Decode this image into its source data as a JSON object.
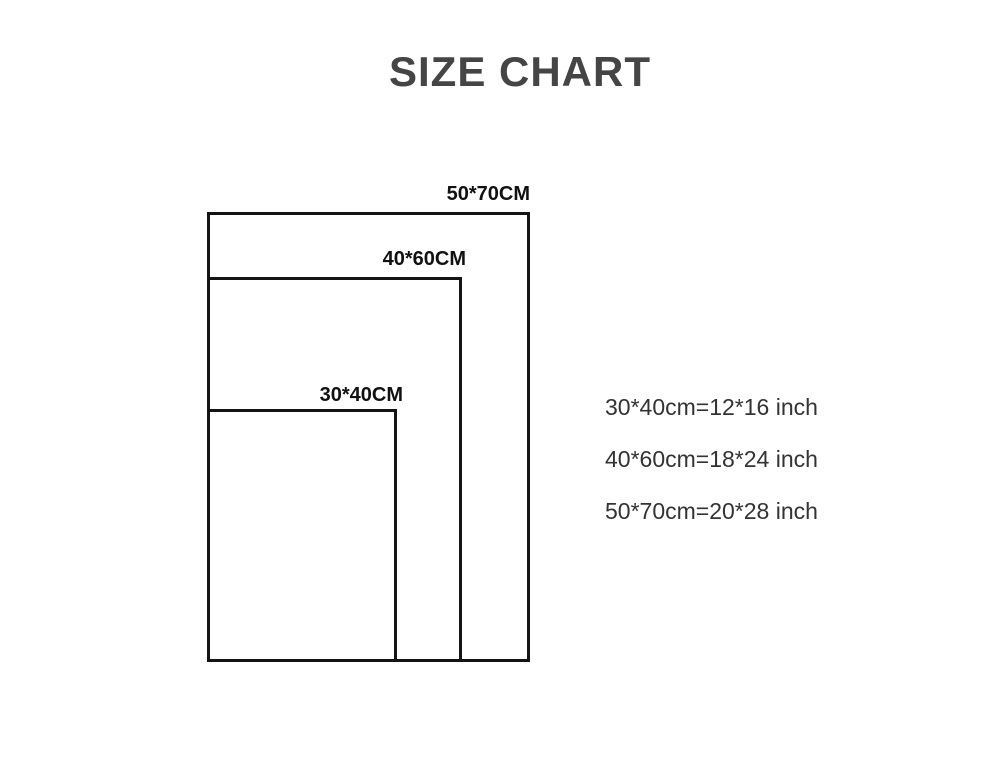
{
  "title": "SIZE CHART",
  "diagram": {
    "rects": [
      {
        "id": "50x70cm",
        "label": "50*70CM"
      },
      {
        "id": "40x60cm",
        "label": "40*60CM"
      },
      {
        "id": "30x40cm",
        "label": "30*40CM"
      }
    ]
  },
  "legend": {
    "lines": [
      "30*40cm=12*16 inch",
      "40*60cm=18*24 inch",
      "50*70cm=20*28 inch"
    ]
  },
  "colors": {
    "background": "#ffffff",
    "title_text": "#454545",
    "rect_border": "#141414",
    "label_text": "#111111",
    "legend_text": "#333333"
  }
}
